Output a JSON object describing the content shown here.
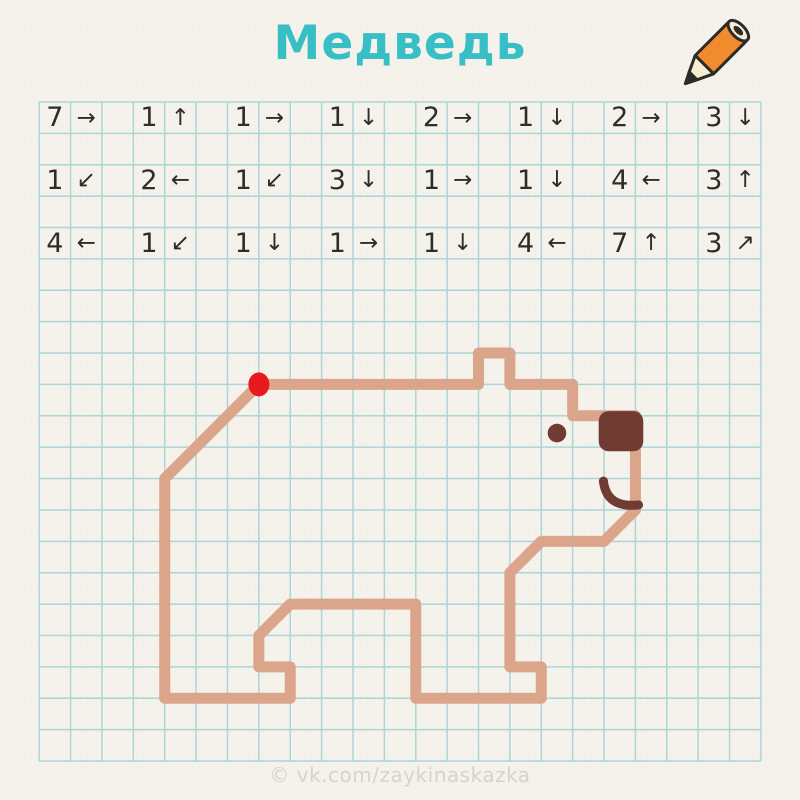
{
  "header": {
    "title": "Медведь",
    "icon": "pencil-icon"
  },
  "watermark": "© vk.com/zaykinaskazka",
  "colors": {
    "background": "#F4F2EB",
    "grid_line": "#AAD6D8",
    "title": "#38BFC6",
    "instruction_text": "#2E2D28",
    "bear_outline": "#DBA58B",
    "bear_dark": "#703B33",
    "start_dot": "#E8191D",
    "pencil_orange": "#F28A2E",
    "pencil_cream": "#F6EDD2",
    "pencil_outline": "#2B2B27",
    "watermark": "#D5D3CB"
  },
  "grid": {
    "origin_x": 39.2,
    "origin_y": 102,
    "cols": 23,
    "rows": 21,
    "cell": 31.38
  },
  "instructions": {
    "grid_rows": [
      0,
      2,
      4
    ],
    "arrow_glyphs": {
      "right": "→",
      "left": "←",
      "up": "↑",
      "down": "↓",
      "down-left": "↙",
      "up-right": "↗"
    },
    "rows": [
      [
        {
          "count": "7",
          "dir": "right"
        },
        {
          "count": "1",
          "dir": "up"
        },
        {
          "count": "1",
          "dir": "right"
        },
        {
          "count": "1",
          "dir": "down"
        },
        {
          "count": "2",
          "dir": "right"
        },
        {
          "count": "1",
          "dir": "down"
        },
        {
          "count": "2",
          "dir": "right"
        },
        {
          "count": "3",
          "dir": "down"
        }
      ],
      [
        {
          "count": "1",
          "dir": "down-left"
        },
        {
          "count": "2",
          "dir": "left"
        },
        {
          "count": "1",
          "dir": "down-left"
        },
        {
          "count": "3",
          "dir": "down"
        },
        {
          "count": "1",
          "dir": "right"
        },
        {
          "count": "1",
          "dir": "down"
        },
        {
          "count": "4",
          "dir": "left"
        },
        {
          "count": "3",
          "dir": "up"
        }
      ],
      [
        {
          "count": "4",
          "dir": "left"
        },
        {
          "count": "1",
          "dir": "down-left"
        },
        {
          "count": "1",
          "dir": "down"
        },
        {
          "count": "1",
          "dir": "right"
        },
        {
          "count": "1",
          "dir": "down"
        },
        {
          "count": "4",
          "dir": "left"
        },
        {
          "count": "7",
          "dir": "up"
        },
        {
          "count": "3",
          "dir": "up-right"
        }
      ]
    ]
  },
  "drawing": {
    "start": {
      "col": 7,
      "row": 9
    },
    "stroke_width": 11,
    "start_dot": {
      "rx": 10.5,
      "ry": 12
    },
    "eye": {
      "col": 16.5,
      "row": 10.55,
      "r": 9.3
    },
    "nose": {
      "col": 17.83,
      "row": 9.85,
      "w_cells": 1.42,
      "h_cells": 1.28,
      "corner": 10
    },
    "mouth": {
      "from": [
        17.98,
        12.08
      ],
      "ctrl": [
        18.08,
        12.95
      ],
      "to": [
        19.1,
        12.84
      ],
      "stroke": 9
    }
  }
}
